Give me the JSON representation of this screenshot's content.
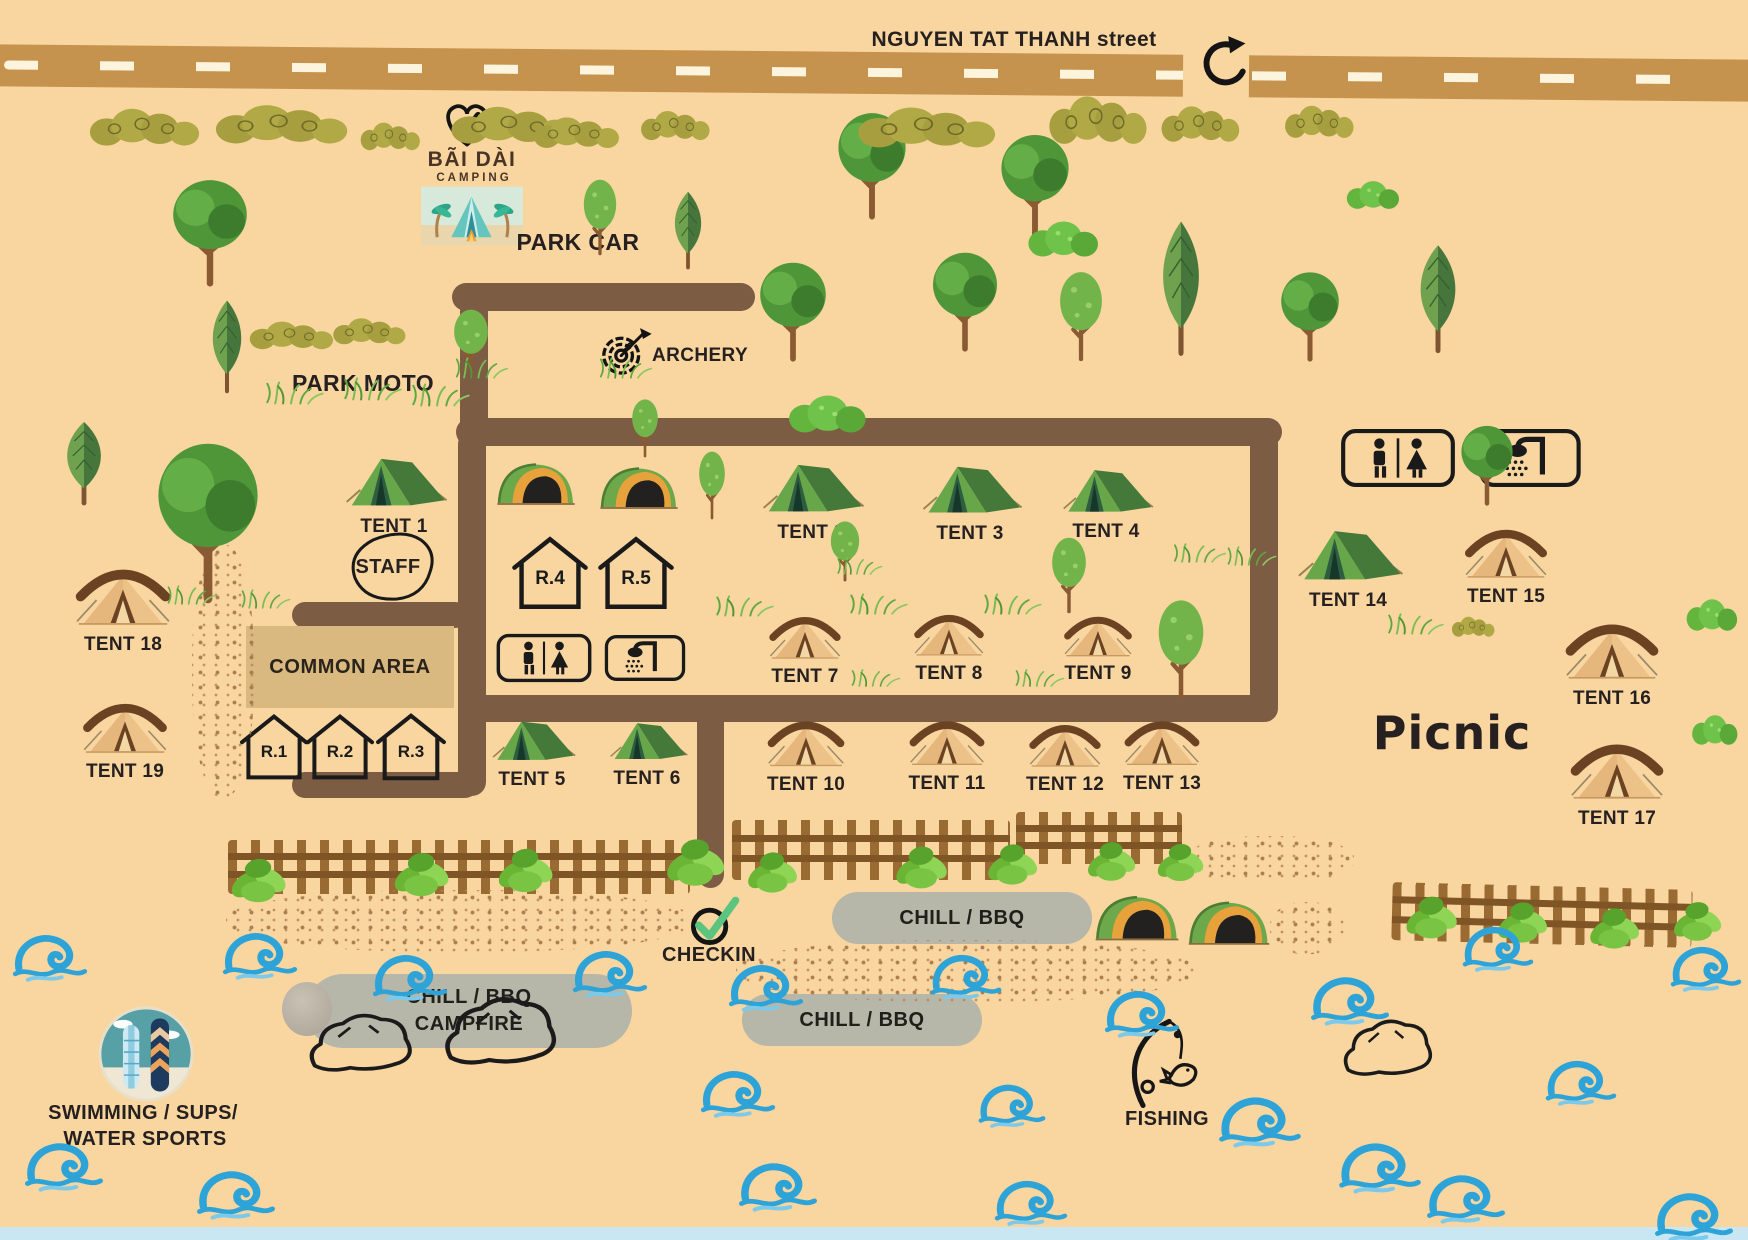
{
  "street": {
    "label": "NGUYEN TAT THANH street"
  },
  "logo": {
    "title": "BÃI DÀI",
    "subtitle": "CAMPING"
  },
  "areas": {
    "park_car": "PARK CAR",
    "park_moto": "PARK MOTO",
    "archery": "ARCHERY",
    "staff": "STAFF",
    "common_area": "COMMON AREA",
    "checkin": "CHECKIN",
    "picnic": "Picnic",
    "fishing": "FISHING",
    "swimming_line1": "SWIMMING / SUPS/",
    "swimming_line2": "WATER SPORTS"
  },
  "pills": {
    "bbq_right": "CHILL / BBQ",
    "bbq_mid": "CHILL / BBQ",
    "campfire_line1": "CHILL / BBQ",
    "campfire_line2": "CAMPFIRE"
  },
  "rooms": [
    {
      "label": "R.1"
    },
    {
      "label": "R.2"
    },
    {
      "label": "R.3"
    },
    {
      "label": "R.4"
    },
    {
      "label": "R.5"
    }
  ],
  "tents": [
    {
      "label": "TENT 1",
      "style": "green"
    },
    {
      "label": "TENT 2",
      "style": "green"
    },
    {
      "label": "TENT 3",
      "style": "green"
    },
    {
      "label": "TENT 4",
      "style": "green"
    },
    {
      "label": "TENT 5",
      "style": "green"
    },
    {
      "label": "TENT 6",
      "style": "green"
    },
    {
      "label": "TENT 7",
      "style": "tan"
    },
    {
      "label": "TENT 8",
      "style": "tan"
    },
    {
      "label": "TENT 9",
      "style": "tan"
    },
    {
      "label": "TENT 10",
      "style": "tan"
    },
    {
      "label": "TENT 11",
      "style": "tan"
    },
    {
      "label": "TENT 12",
      "style": "tan"
    },
    {
      "label": "TENT 13",
      "style": "tan"
    },
    {
      "label": "TENT 14",
      "style": "green"
    },
    {
      "label": "TENT 15",
      "style": "tan"
    },
    {
      "label": "TENT 16",
      "style": "tan"
    },
    {
      "label": "TENT 17",
      "style": "tan"
    },
    {
      "label": "TENT 18",
      "style": "tan"
    },
    {
      "label": "TENT 19",
      "style": "tan"
    }
  ],
  "icons": {
    "logo_heart": "heart-check-icon",
    "entrance_arrow": "u-turn-arrow-icon",
    "archery": "target-arrow-icon",
    "restroom": "restroom-icon",
    "shower": "shower-icon",
    "checkin": "check-circle-icon",
    "fishing": "fishing-rod-icon",
    "swimming": "surfboards-icon"
  },
  "colors": {
    "background": "#f9d6a0",
    "street": "#c6934e",
    "inner_path": "#7d5c44",
    "water": "#2ea3d8",
    "pill_gray": "#b6b6a9",
    "common_area": "#d9b97f",
    "logo_brown": "#4a3426",
    "check_green": "#5bc47e"
  }
}
